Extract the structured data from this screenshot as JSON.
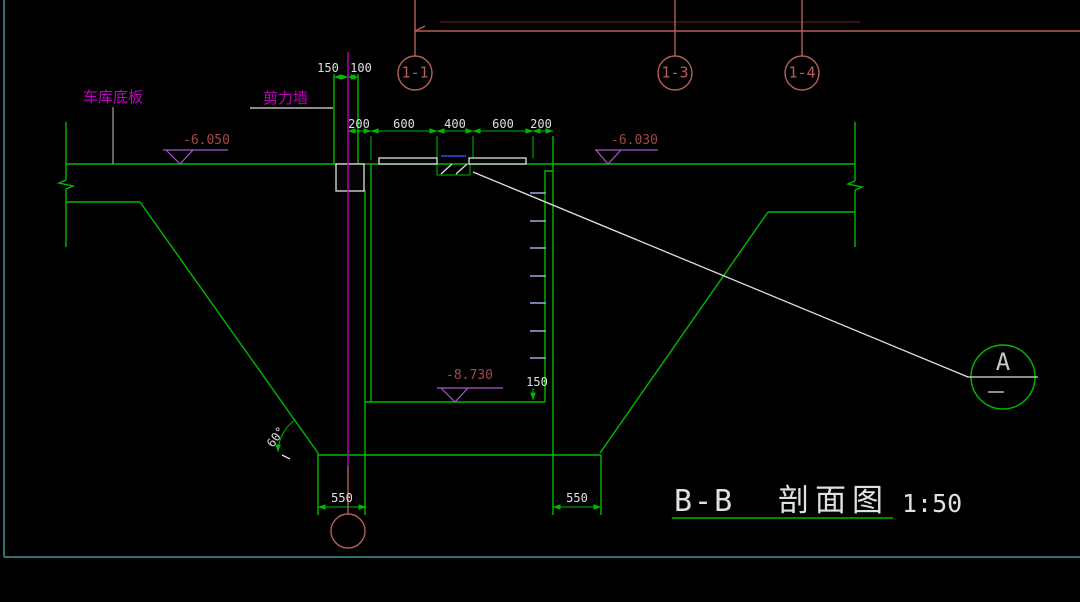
{
  "colors": {
    "bg": "#000000",
    "green": "#00b800",
    "magenta": "#bf00bf",
    "salmon": "#b46058",
    "darkred": "#5a1c1c",
    "elev_text": "#a34848",
    "elev_mark": "#a858cc",
    "white": "#e0e0e0",
    "gray": "#a0a0a0",
    "teal": "#2f6f6f",
    "rung": "#9aa8e0",
    "blue": "#2a35b8"
  },
  "axis_bubbles": [
    {
      "label": "1-1"
    },
    {
      "label": "1-3"
    },
    {
      "label": "1-4"
    }
  ],
  "labels": {
    "garage_slab": "车库底板",
    "shear_wall": "剪力墙",
    "angle": "60°",
    "detail_letter": "A"
  },
  "elevations": {
    "slab_left": "-6.050",
    "slab_right": "-6.030",
    "pit_bottom": "-8.730"
  },
  "dims": {
    "wall_top": [
      "150",
      "100"
    ],
    "pit_top": [
      "200",
      "600",
      "400",
      "600",
      "200"
    ],
    "bottom_left": "550",
    "bottom_right": "550",
    "pit_wall": "150"
  },
  "title": {
    "name": "B-B",
    "type": "剖面图",
    "scale": "1:50"
  }
}
